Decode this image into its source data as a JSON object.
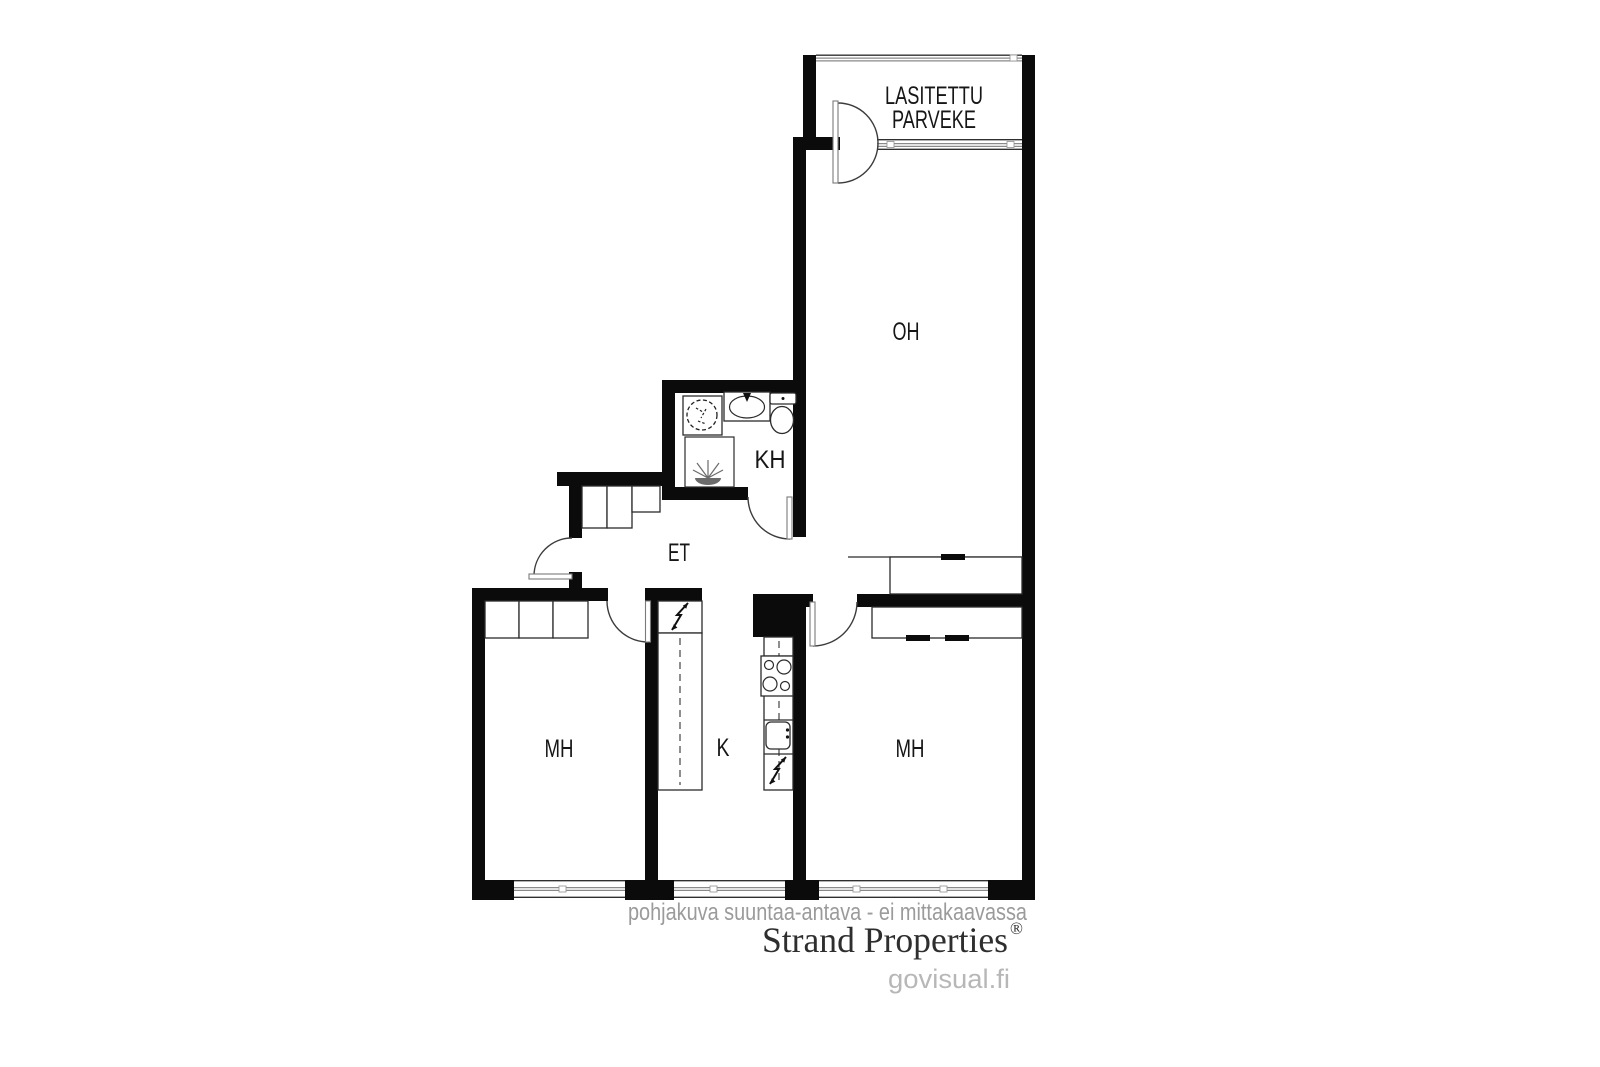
{
  "rooms": {
    "balcony_line1": "LASITETTU",
    "balcony_line2": "PARVEKE",
    "living_room": "OH",
    "bathroom": "KH",
    "hallway": "ET",
    "bedroom_left": "MH",
    "kitchen": "K",
    "bedroom_right": "MH"
  },
  "footer": {
    "disclaimer": "pohjakuva suuntaa-antava - ei mittakaavassa",
    "brand": "Strand Properties",
    "registered_mark": "®",
    "watermark": "govisual.fi"
  },
  "colors": {
    "wall": "#0b0b0b",
    "window_frame_dark": "#2f2f2f",
    "window_frame_gray": "#8a8a8a",
    "fixture_line": "#2b2b2b",
    "label_text": "#161616",
    "disclaimer_text": "#9b9b9b",
    "brand_text": "#2e2e2e",
    "watermark_text": "#b7b7b7"
  },
  "fixtures": {
    "bathroom": [
      "washing-machine",
      "sink",
      "toilet",
      "shower-floor-drain"
    ],
    "kitchen": [
      "electrical-panel",
      "counter-left",
      "counter-right",
      "stove",
      "sink",
      "electrical-point",
      "flue-shaft"
    ],
    "storage": [
      "hallway-wardrobe",
      "bedroom-left-wardrobe",
      "living-room-wardrobe",
      "bedroom-right-wardrobe"
    ]
  }
}
